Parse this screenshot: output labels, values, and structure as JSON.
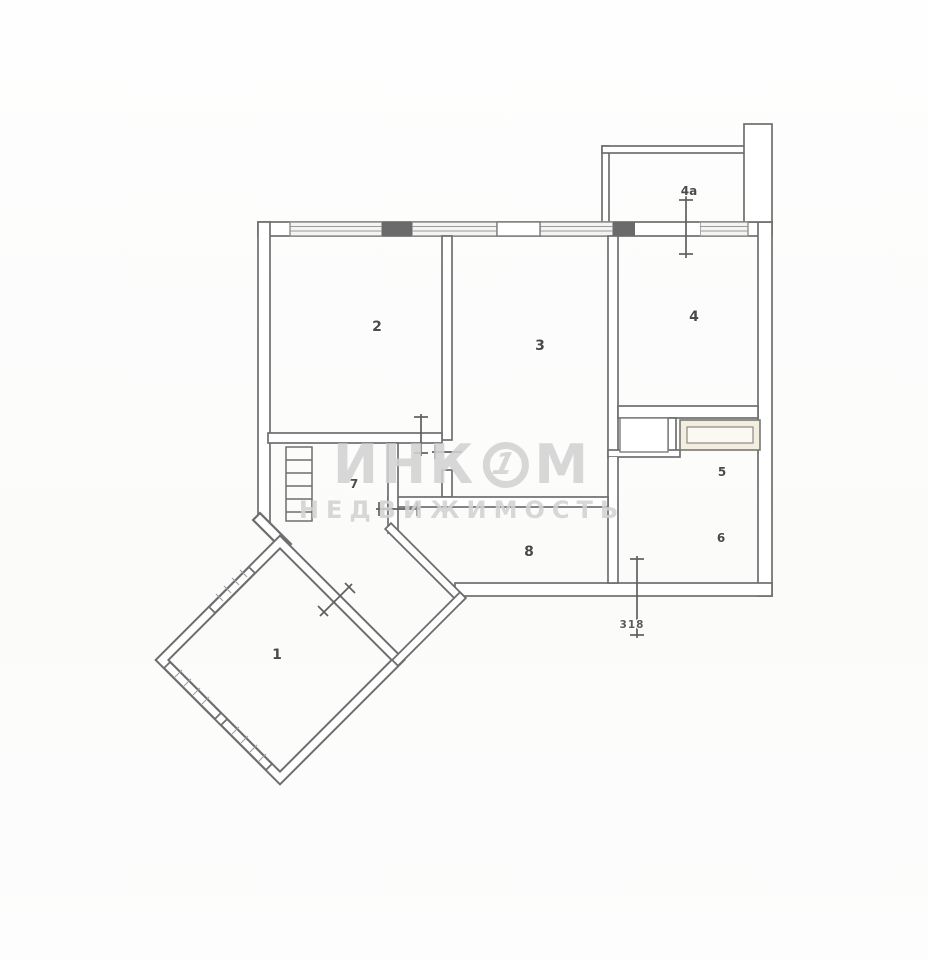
{
  "document_type": "apartment-floor-plan-scan",
  "watermark": {
    "brand_prefix": "ИНК",
    "brand_circle_char": "1",
    "brand_suffix": "М",
    "tagline": "НЕДВИЖИМОСТЬ"
  },
  "rooms": [
    {
      "id": "room-1",
      "label": "1"
    },
    {
      "id": "room-2",
      "label": "2"
    },
    {
      "id": "room-3",
      "label": "3"
    },
    {
      "id": "room-4",
      "label": "4"
    },
    {
      "id": "balcony-4a",
      "label": "4а"
    },
    {
      "id": "room-5",
      "label": "5"
    },
    {
      "id": "room-6",
      "label": "6"
    },
    {
      "id": "room-7",
      "label": "7"
    },
    {
      "id": "room-8",
      "label": "8"
    }
  ],
  "entrance": {
    "door_number": "318"
  },
  "colors": {
    "wall": "#6e6e6e",
    "label": "#4a4a4a",
    "wm": "#d3d3d3",
    "wardrobe_fill": "#f3eedd"
  }
}
